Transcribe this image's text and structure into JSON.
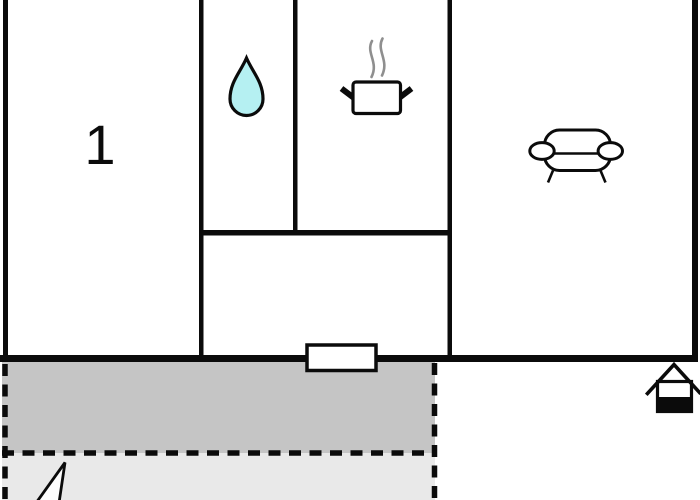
{
  "room_label": "1",
  "icons": {
    "bathroom": "water-drop-icon",
    "kitchen": "cooking-pot-icon",
    "kitchen_steam": "steam-icon",
    "living_room": "sofa-icon",
    "entrance": "door-icon",
    "property": "house-icon",
    "compass": "north-arrow-icon"
  },
  "colors": {
    "background": "#ffffff",
    "wall": "#0b0b0b",
    "water_drop_fill": "#b5f0f2",
    "steam": "#8f8f8f",
    "terrace": "#c5c5c5",
    "lawn": "#e9e9e9",
    "door_fill": "#ffffff",
    "house_base_fill": "#0b0b0b"
  }
}
